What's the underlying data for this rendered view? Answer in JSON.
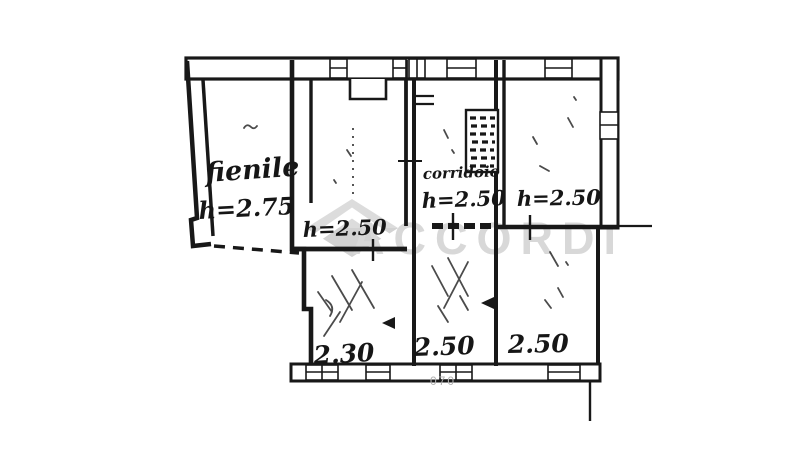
{
  "document": {
    "type": "scanned-floorplan",
    "background_color": "#ffffff",
    "ink_color": "#181818"
  },
  "watermark": {
    "text": "ACCORDI",
    "color": "#d8d8d8",
    "logo": "house-logo"
  },
  "plan": {
    "rooms": {
      "fienile": {
        "name": "fienile",
        "height": "h=2.75"
      },
      "room_top_middle": {
        "height": "h=2.50"
      },
      "corridor": {
        "name": "corridoio",
        "height": "h=2.50"
      },
      "room_top_right": {
        "height": "h=2.50"
      },
      "room_bottom_left": {
        "width": "2.30"
      },
      "room_bottom_middle": {
        "width": "2.50"
      },
      "room_bottom_right": {
        "width": "2.50"
      }
    },
    "faint_note": "070",
    "features": [
      "staircase-hatch",
      "dashed-open-side",
      "window-openings",
      "pencil-scribbles"
    ]
  }
}
